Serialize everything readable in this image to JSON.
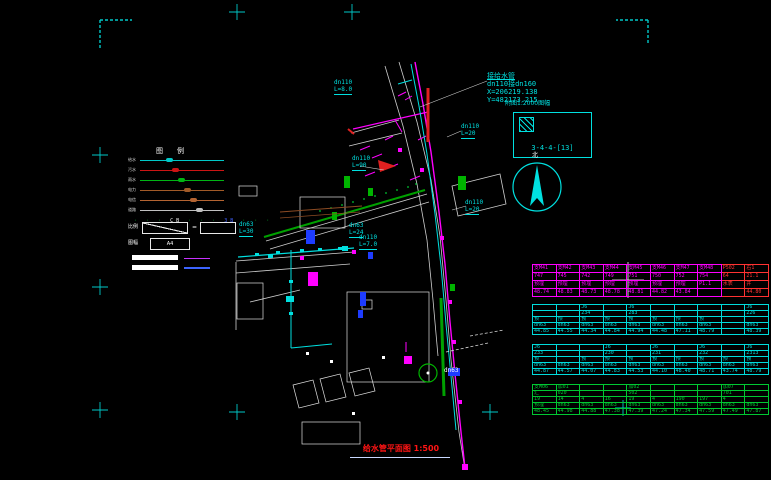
{
  "title": {
    "text": "给水管平面图 1:500"
  },
  "index_box": {
    "caption": "附图1:2000图幅",
    "code": "3-4-4-[13]"
  },
  "annotation": {
    "line0": "接给水管",
    "line1": "dn110接dn160",
    "line2": "X=206219.138",
    "line3": "Y=482173.215"
  },
  "north_label": "北",
  "legend": {
    "header": "图例",
    "lines": [
      {
        "label": "给水",
        "color": "#00c8c8"
      },
      {
        "label": "污水",
        "color": "#cc1414"
      },
      {
        "label": "雨水",
        "color": "#00b414"
      },
      {
        "label": "电力",
        "color": "#a05a28"
      },
      {
        "label": "电信",
        "color": "#b46432"
      },
      {
        "label": "道路",
        "color": "#c0c0c0"
      }
    ],
    "symbols_dots": "· · ·",
    "symbols_t1": "CB",
    "symbols_t2": "3B",
    "scale_label": "比例",
    "eq": "=",
    "sheet_label": "图幅",
    "a4": "A4"
  },
  "map_labels": [
    {
      "t": "dn110",
      "x": 334,
      "y": 80,
      "c": "cy"
    },
    {
      "t": "L=8.0",
      "x": 334,
      "y": 87,
      "c": "cy",
      "u": 1
    },
    {
      "t": "dn110",
      "x": 352,
      "y": 156,
      "c": "cy"
    },
    {
      "t": "L=90",
      "x": 352,
      "y": 163,
      "c": "cy",
      "u": 1
    },
    {
      "t": "dn110",
      "x": 461,
      "y": 124,
      "c": "cy"
    },
    {
      "t": "L=20",
      "x": 461,
      "y": 131,
      "c": "cy",
      "u": 1
    },
    {
      "t": "dn110",
      "x": 465,
      "y": 200,
      "c": "cy"
    },
    {
      "t": "L=20",
      "x": 465,
      "y": 207,
      "c": "cy",
      "u": 1
    },
    {
      "t": "dn63",
      "x": 239,
      "y": 222,
      "c": "cy"
    },
    {
      "t": "L=30",
      "x": 239,
      "y": 229,
      "c": "cy",
      "u": 1
    },
    {
      "t": "dn63",
      "x": 349,
      "y": 223,
      "c": "cy"
    },
    {
      "t": "L=24",
      "x": 349,
      "y": 230,
      "c": "cy",
      "u": 1
    },
    {
      "t": "dn110",
      "x": 359,
      "y": 235,
      "c": "cy"
    },
    {
      "t": "L=7.0",
      "x": 359,
      "y": 242,
      "c": "cy",
      "u": 1
    },
    {
      "t": "dn63",
      "x": 444,
      "y": 368,
      "c": "wh"
    }
  ],
  "table": {
    "x": 532,
    "y": 264,
    "groups": [
      {
        "color": "#ff00ff",
        "row_h": 10,
        "red_cols": [
          8,
          9
        ],
        "red": "#ff3232",
        "rows": [
          [
            "支M41",
            "支M42",
            "支M43",
            "支M44",
            "支M45",
            "支M46",
            "支M47",
            "支M48",
            "P502",
            "右1"
          ],
          [
            "747",
            "745",
            "742",
            "749",
            "751",
            "750",
            "752",
            "754",
            "64",
            "21.1"
          ],
          [
            "预埋",
            "预埋",
            "预埋",
            "预埋",
            "预埋",
            "预埋",
            "预埋",
            "P1.1",
            "水表",
            "井"
          ],
          [
            "48.74",
            "48.83",
            "48.73",
            "48.78",
            "48.81",
            "44.82",
            "43.84",
            "",
            "",
            "44.80"
          ]
        ]
      },
      {
        "color": "#00dcdc",
        "row_h": 8,
        "rows": [
          [
            "",
            "",
            "J6",
            "",
            "J6",
            "",
            "",
            "",
            "",
            "J6"
          ],
          [
            "",
            "",
            "234",
            "",
            "283",
            "",
            "",
            "",
            "",
            "226"
          ],
          [
            "预",
            "预",
            "预",
            "预",
            "预",
            "预",
            "预",
            "预",
            "",
            ""
          ],
          [
            "dn63",
            "dn63",
            "dn63",
            "dn63",
            "dn63",
            "dn63",
            "dn63",
            "dn63",
            "",
            "dn63"
          ],
          [
            "44.85",
            "44.55",
            "44.34",
            "44.84",
            "44.94",
            "44.48",
            "47.11",
            "48.79",
            "",
            "48.39"
          ]
        ]
      },
      {
        "color": "#00dcdc",
        "row_h": 8,
        "rows": [
          [
            "J6",
            "",
            "",
            "J6",
            "",
            "J6",
            "",
            "J6",
            "",
            "J6"
          ],
          [
            "233",
            "",
            "",
            "230",
            "",
            "231",
            "",
            "232",
            "",
            "2313"
          ],
          [
            "预",
            "",
            "预",
            "预",
            "预",
            "预",
            "预",
            "预",
            "预",
            "预"
          ],
          [
            "dn63",
            "dn63",
            "dn63",
            "dn63",
            "dn63",
            "dn63",
            "dn63",
            "dn63",
            "dn63",
            "dn63"
          ],
          [
            "44.87",
            "44.57",
            "44.07",
            "44.83",
            "44.53",
            "44.10",
            "48.40",
            "48.71",
            "43.74",
            "48.79"
          ]
        ]
      },
      {
        "color": "#00c832",
        "row_h": 7,
        "rows": [
          [
            "支M06",
            "加01",
            "",
            "",
            "加02",
            "",
            "",
            "",
            "加07",
            ""
          ],
          [
            "汇",
            "020",
            "",
            "",
            "502",
            "",
            "",
            "",
            "701",
            ""
          ],
          [
            "19",
            "14",
            "4",
            "16",
            "19",
            "4",
            "190",
            "197",
            "4",
            ""
          ],
          [
            "预埋",
            "dn63",
            "dn63",
            "dn63",
            "dn63",
            "dn63",
            "dn63",
            "dn63",
            "dn63",
            "dn63"
          ],
          [
            "48.45",
            "44.98",
            "44.88",
            "47.38",
            "47.39",
            "47.24",
            "47.34",
            "47.59",
            "47.49",
            "47.87"
          ]
        ]
      }
    ]
  }
}
